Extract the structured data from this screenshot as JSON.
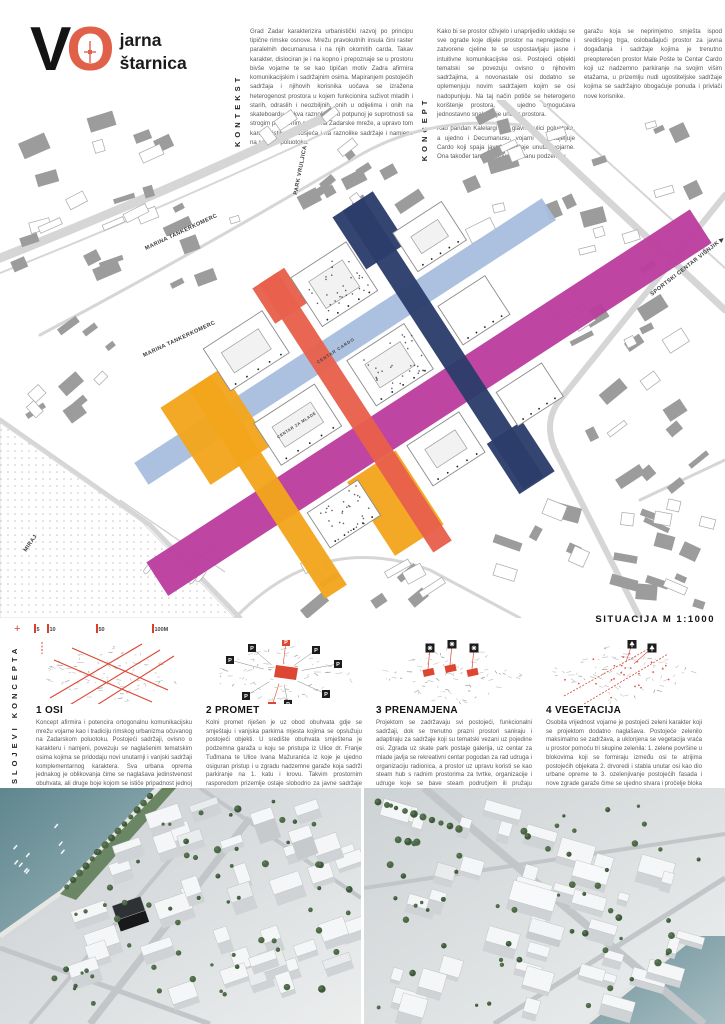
{
  "logo": {
    "v": "V",
    "o": "O",
    "word1": "jarna",
    "word2": "štarnica"
  },
  "kontekst": {
    "label": "KONTEKST",
    "text": "Grad Zadar karakterizira urbanistički razvoj po principu tipične rimske osnove. Mrežu pravokutnih insula čini raster paralelnih decumanusa i na njih okomitih carda. Takav karakter, dislociran je i na kopno i prepoznaje se u prostoru bivše vojarne te se kao tipičan motiv Zadra afirmira komunikacijskim i sadržajnim osima. Mapiranjem postojećih sadržaja i njihovih korisnika uočava se izražena heterogenost prostora u kojem funkcionira suživot mladih i starih, odraslih i neozbiljnih, onih u odijelima i onih na skateboardu. Takva raznolikost u potpunoj je suprotnosti sa strogim prostornim pravilima Zadarske mreže, a upravo tom karakteristikom podsjeća i na raznolike sadržaje i namjene na samom poluotoku."
  },
  "koncept": {
    "label": "KONCEPT",
    "col1_p1": "Kako bi se prostor oživjelo i unaprijedilo ukidaju se sve ograde koje dijele prostor na nepregledne i zatvorene cjeline te se uspostavljaju jasne i intuitivne komunikacijske osi. Postojeći objekti tematski se povezuju ovisno o njihovim sadržajima, a novonastale osi dodatno se oplemenjuju novim sadržajem kojim se osi nadopunjuju. Na taj način potiče se heterogeno korištenje prostora, no ujedno omogućava jednostavno snalaženje unutar prostora.",
    "col1_p2": "Kao pandan Kalelargi kao glavnoj ulici poluotoka, a ujedno i Decumanusu, vojarni se dodjeljuje Cardo koji spaja javne sadržaje unutar vojarne. Ona također tangira i novoformiranu podzemnu",
    "col2": "garažu koja se neprimjetno smješta ispod središnjeg trga, oslobađajući prostor za javna događanja i sadržaje kojima je trenutno preopterećen prostor Male Pošte te Centar Cardo koji uz nadzemno parkiranje na svojim višim etažama, u prizemlju nudi ugostiteljske sadržaje kojima se sadržajno obogaćuje ponuda i privlači nove korisnike."
  },
  "map": {
    "caption": "SITUACIJA M 1:1000",
    "scale_ticks": [
      "5",
      "10",
      "50",
      "100M"
    ],
    "streets": [
      "PARK VRULJICA",
      "MARINA TANKERKOMERC",
      "MARINA TANKERKOMERC",
      "SPORTSKI CENTAR VIŠNJIK ▶",
      "MIRAJ"
    ],
    "area_labels": [
      "CENTAR CARDO",
      "CENTAR ZA MLADE"
    ],
    "colors": {
      "orange": "#F3A61C",
      "red": "#E8604C",
      "blue": "#A9BEDE",
      "navy": "#2C3D6B",
      "magenta": "#BB3D9E"
    }
  },
  "layers": {
    "label": "SLOJEVI KONCEPTA",
    "markers": {
      "parking": "P"
    },
    "items": [
      {
        "title": "1 OSI",
        "text": "Koncept afirmira i potencira ortogonalnu komunikacijsku mrežu vojarne kao i tradiciju rimskog urbanizma očuvanog na Zadarskom poluotoku. Postojeći sadržaji, ovisno o karakteru i namjeni, povezuju se naglašenim tematskim osima kojima se pridodaju novi unutarnji i vanjski sadržaji komplementarnog karaktera. Sva urbana oprema jednakog je oblikovanja čime se naglašava jedinstvenost obuhvata, ali druge boje kojom se ističe pripadnost jednoj od pet novoformiranih osi."
      },
      {
        "title": "2 PROMET",
        "text": "Kolni promet riješen je uz obod obuhvata gdje se smještaju i vanjska parkirna mjesta kojima se opslužuju postojeći objekti. U središte obuhvata smještena je podzemna garaža u koju se pristupa iz Ulice dr. Franje Tuđmana te Ulice Ivana Mažuranića iz koje je ujedno osiguran pristup i u zgradu nadzemne garaže koja sadrži parkiranje na 1. katu i krovu. Takvim prostornim rasporedom prizemlje ostaje slobodno za javne sadržaje kojima se dodatno aktivira prostor."
      },
      {
        "title": "3 PRENAMJENA",
        "text": "Projektom se zadržavaju svi postojeći, funkcionalni sadržaji, dok se trenutno prazni prostori saniraju i adaptiraju za sadržaje koji su tematski vezani uz pojedine osi. Zgrada uz skate park postaje galerija, uz centar za mlade javlja se rekreativni centar pogodan za rad udruga i organizaciju radionica, a prostor uz upravu koristi se kao steam hub s radnim prostorima za tvrtke, organizacije i udruge koje se bave steam područjem ili pružaju edukaciju iz nekog od pripadajućih područja."
      },
      {
        "title": "4 VEGETACIJA",
        "text": "Osobita vrijednost vojarne je postojeći zeleni karakter koji se projektom dodatno naglašava. Postojeće zelenilo maksimalno se zadržava, a uklonjena se vegetacija vraća u prostor pomoću tri skupine zelenila: 1. zelene površine u blokovima koji se formiraju između osi te atrijima postojećih objekata 2. drvoredi i stabla unutar osi kao dio urbane opreme te 3. ozelenjivanje postojećih fasada i nove zgrade garaže čime se ujedno stvara i pročelje bloka prema okolnim prometnicama."
      }
    ]
  },
  "render_colors": {
    "water": "#6E949B",
    "tree": "#4C6847",
    "dark_building": "#2E3234"
  }
}
